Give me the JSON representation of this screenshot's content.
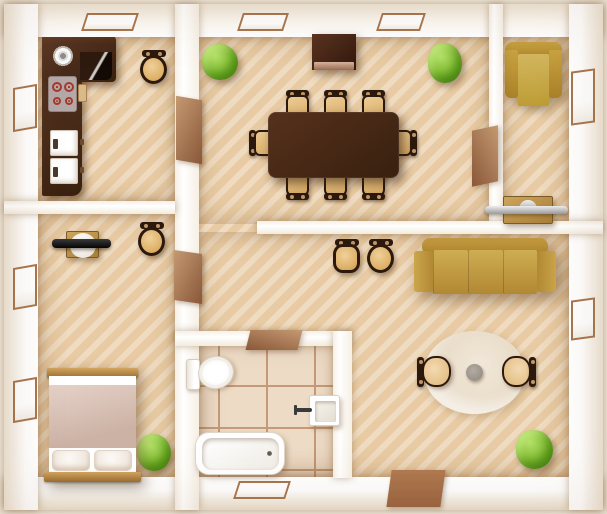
{
  "scene": {
    "kind": "apartment-floor-plan-top-view",
    "style": "flat illustrated top-down floor plan, warm wood tones",
    "counts": {
      "rooms": 6,
      "windows": 9,
      "doors": 5,
      "plants": 4,
      "dining_chairs": 8
    }
  },
  "palette": {
    "floor_wood": "#e7c9a0",
    "floor_stripe": "#f0d9b4",
    "tile_floor": "#eddbc6",
    "tile_grout": "#c49a78",
    "wall_white": "#ffffff",
    "wall_shade": "#efe5d5",
    "dark_wood": "#4a2a16",
    "mid_wood": "#b9894d",
    "chair_seat": "#e3bc7f",
    "chair_frame": "#2c190e",
    "sofa_gold": "#c19a3f",
    "plant_green": "#7cba2e",
    "door_brown": "#b98a6a",
    "window_frame": "#a8764e",
    "fixture_white": "#ffffff",
    "metal_gray": "#b9bcbe",
    "burner_red": "#a43a2c",
    "rug_cream": "#ece0cf"
  },
  "rooms": {
    "kitchen": {
      "name": "Kitchen",
      "windows": 2,
      "items": [
        "L-shaped dark counter",
        "round sink",
        "4-burner cooktop",
        "cutting board",
        "oven",
        "dishwasher",
        "stool"
      ]
    },
    "dining": {
      "name": "Dining room",
      "windows": 2,
      "items": [
        "large dining table",
        "8 chairs",
        "sideboard",
        "2 plants"
      ]
    },
    "study": {
      "name": "Study",
      "windows": 1,
      "items": [
        "armchair",
        "wall console with metal shelf"
      ]
    },
    "bedroom": {
      "name": "Bedroom",
      "windows": 2,
      "items": [
        "double bed with 2 pillows",
        "desk with TV",
        "stool",
        "plant"
      ]
    },
    "bathroom": {
      "name": "Bathroom",
      "windows": 1,
      "items": [
        "toilet",
        "wash basin",
        "bathtub"
      ]
    },
    "living": {
      "name": "Living room",
      "windows": 1,
      "items": [
        "3-seat sofa",
        "2 stools",
        "round rug",
        "round coffee table",
        "2 chairs",
        "plant"
      ]
    }
  },
  "doors": {
    "kitchen": "kitchen to hallway",
    "bedroom": "bedroom to hallway",
    "study": "study to dining room",
    "bathroom": "bathroom to living area",
    "entry": "main entry door, bottom wall"
  }
}
